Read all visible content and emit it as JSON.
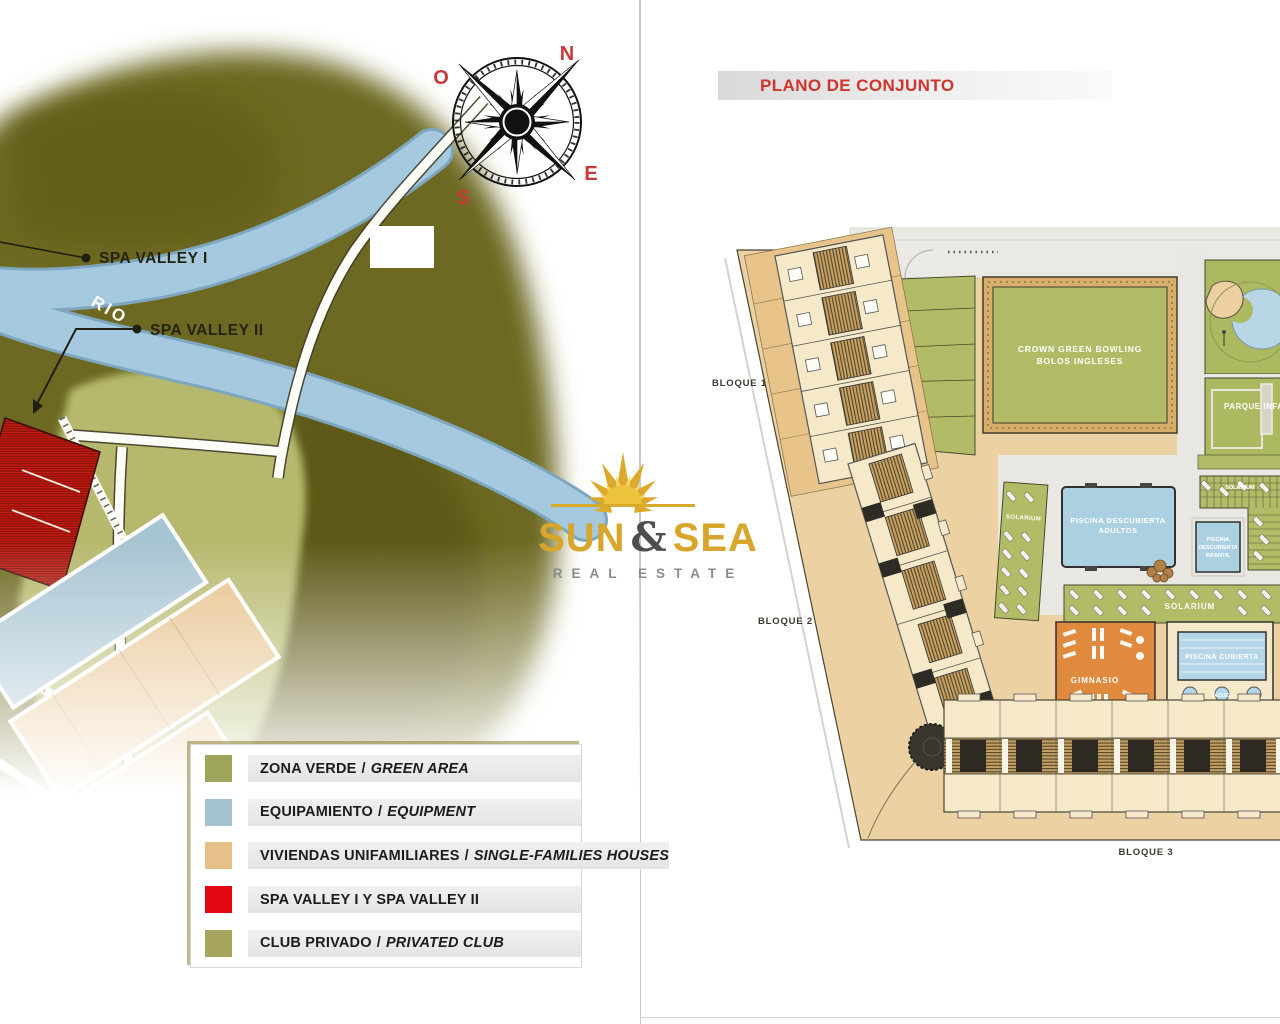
{
  "colors": {
    "accent_red": "#e30613",
    "map_olive": "#6d6920",
    "map_olive_dark": "#5c5712",
    "map_green_light": "#b6b96d",
    "river_blue": "#a5cadf",
    "tan": "#ecd2a2",
    "cream": "#f3e6c4",
    "plan_green": "#b2bb66",
    "pool_blue": "#a9cfe2",
    "orange": "#e08438",
    "deck_gray": "#e7e5e0"
  },
  "logo": {
    "word1": "SUN",
    "ampersand": "&",
    "word2": "SEA",
    "subtitle": "REAL ESTATE"
  },
  "left_map": {
    "compass": {
      "north": "N",
      "east": "E",
      "south": "S",
      "west": "O"
    },
    "river_label": "RIO",
    "callout_1": "SPA VALLEY I",
    "callout_2": "SPA VALLEY II",
    "legend": {
      "items": [
        {
          "label_es": "ZONA VERDE",
          "sep": "/",
          "label_en": "GREEN AREA",
          "color": "#9fa65c"
        },
        {
          "label_es": "EQUIPAMIENTO",
          "sep": "/",
          "label_en": "EQUIPMENT",
          "color": "#a4c1ce"
        },
        {
          "label_es": "VIVIENDAS UNIFAMILIARES",
          "sep": "/",
          "label_en": "SINGLE-FAMILIES HOUSES",
          "color": "#e5c088"
        },
        {
          "label_es": "SPA VALLEY I Y SPA VALLEY II",
          "sep": "",
          "label_en": "",
          "color": "#e30613"
        },
        {
          "label_es": "CLUB PRIVADO",
          "sep": "/",
          "label_en": "PRIVATED CLUB",
          "color": "#a6a65f"
        }
      ]
    }
  },
  "right_plan": {
    "title": "PLANO DE CONJUNTO",
    "block_1": "BLOQUE 1",
    "block_2": "BLOQUE 2",
    "block_3": "BLOQUE 3",
    "bowling_line1": "CROWN GREEN BOWLING",
    "bowling_line2": "BOLOS INGLESES",
    "pool_adults_line1": "PISCINA DESCUBIERTA",
    "pool_adults_line2": "ADULTOS",
    "pool_kids_line1": "PISCINA",
    "pool_kids_line2": "DESCUBIERTA",
    "pool_kids_line3": "INFANTIL",
    "solarium_left": "SOLARIUM",
    "solarium_top": "SOLARIUM",
    "solarium_main": "SOLARIUM",
    "gym": "GIMNASIO",
    "indoor_pool": "PISCINA CUBIERTA",
    "jacuzzi": "JACUZZI",
    "park": "PARQUE INFANTIL"
  }
}
